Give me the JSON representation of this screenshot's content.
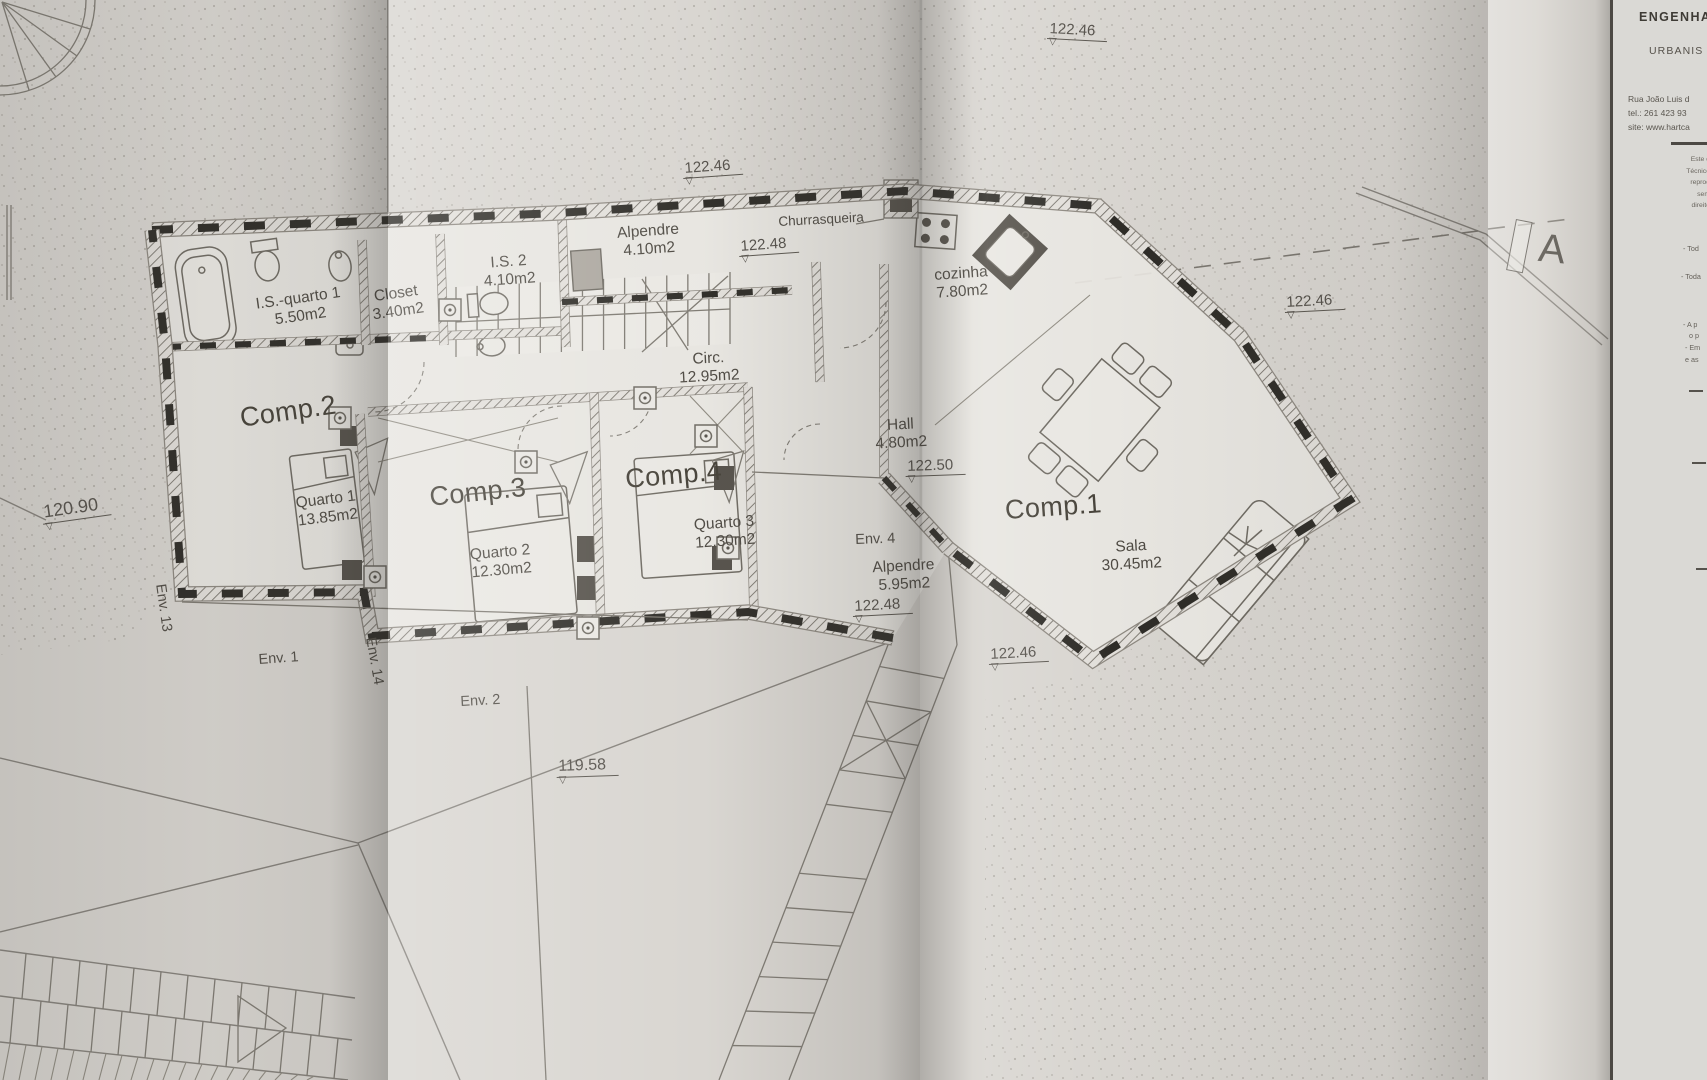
{
  "document": {
    "type": "architectural floor plan photo"
  },
  "colors": {
    "paper": "#d8d5d0",
    "paper_bright": "#e8e6e1",
    "ink": "#4a463f",
    "wall_dash": "#2e2c27",
    "hatch_line": "#6f6b63"
  },
  "icons": {
    "level_triangle": "▽"
  },
  "title_block": {
    "company_line1": "ENGENHA",
    "company_line2": "URBANIS",
    "address_line": "Rua João Luis d",
    "tel_line": "tel.: 261 423 93",
    "site_line": "site: www.hartca",
    "disclaimer_lines": [
      "Este d",
      "Técnico",
      "reprod",
      "sem",
      "direito"
    ],
    "note_lines": [
      "- Tod",
      "- Toda",
      "- A p",
      "o p",
      "- Em",
      "e as"
    ]
  },
  "section_marker": {
    "label": "A"
  },
  "rooms": {
    "is_quarto1": {
      "name": "I.S.-quarto 1",
      "area": "5.50m2"
    },
    "closet": {
      "name": "Closet",
      "area": "3.40m2"
    },
    "is2": {
      "name": "I.S. 2",
      "area": "4.10m2"
    },
    "comp2": {
      "name": "Comp.2"
    },
    "quarto1": {
      "name": "Quarto 1",
      "area": "13.85m2"
    },
    "comp3": {
      "name": "Comp.3"
    },
    "quarto2": {
      "name": "Quarto 2",
      "area": "12.30m2"
    },
    "comp4": {
      "name": "Comp.4"
    },
    "quarto3": {
      "name": "Quarto 3",
      "area": "12.30m2"
    },
    "circ": {
      "name": "Circ.",
      "area": "12.95m2"
    },
    "alpendre_top": {
      "name": "Alpendre",
      "area": "4.10m2"
    },
    "churrasqueira": {
      "name": "Churrasqueira"
    },
    "cozinha": {
      "name": "cozinha",
      "area": "7.80m2"
    },
    "hall": {
      "name": "Hall",
      "area": "4.80m2"
    },
    "comp1": {
      "name": "Comp.1"
    },
    "sala": {
      "name": "Sala",
      "area": "30.45m2"
    },
    "env4_porch": {
      "name": "Alpendre",
      "area": "5.95m2"
    }
  },
  "levels": {
    "top_right": "122.46",
    "alpendre_top": "122.46",
    "alpendre_top2": "122.48",
    "right_mid": "122.46",
    "hall": "122.50",
    "porch": "122.48",
    "stair_top": "122.46",
    "west": "120.90",
    "south": "119.58"
  },
  "env_markers": {
    "env1": "Env. 1",
    "env2": "Env. 2",
    "env4": "Env. 4",
    "env13": "Env. 13",
    "env14": "Env. 14"
  }
}
